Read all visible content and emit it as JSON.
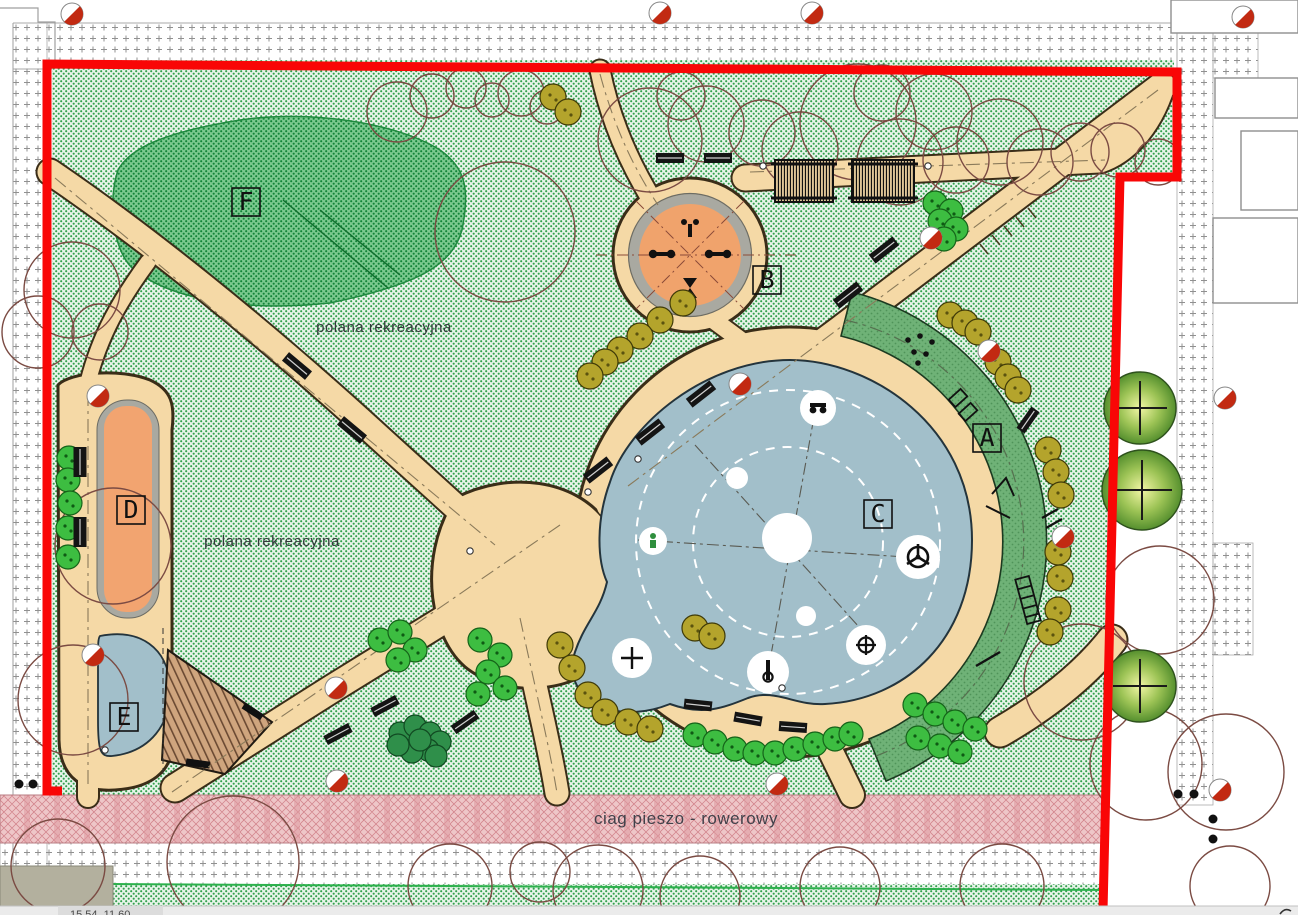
{
  "plan_labels": {
    "area_a": "A",
    "area_b": "B",
    "area_c": "C",
    "area_d": "D",
    "area_e": "E",
    "area_f": "F",
    "meadow_upper": "polana rekreacyjna",
    "meadow_lower": "polana rekreacyjna",
    "pedestrian_bike_path": "ciag pieszo - rowerowy"
  },
  "status_bar": {
    "coordinates_text": "15.54, 11.60"
  },
  "legend_colors": {
    "site_boundary_red": "#f90606",
    "lawn_green_stipple": "#e8f4ea",
    "meadow_dark_green": "#7bc98f",
    "path_beige": "#f5d9a6",
    "water_play_blue": "#a2bfca",
    "equipment_orange": "#f0a36c",
    "fitness_arc_green": "#6fb277",
    "bike_path_pink": "#eec6c8",
    "sidewalk_hatch_gray": "#909090"
  },
  "icons": {
    "survey_marker": "survey-marker-icon",
    "bench": "bench-icon",
    "pergola": "pergola-icon",
    "existing_tree": "existing-tree-icon",
    "new_tree": "new-tree-icon",
    "gym_equipment": "gym-equipment-icon",
    "helm": "helm-icon",
    "circled_plus": "circled-plus-icon",
    "plus": "plus-icon",
    "person": "person-icon",
    "water_pump": "water-pump-icon",
    "ladder": "ladder-icon"
  }
}
